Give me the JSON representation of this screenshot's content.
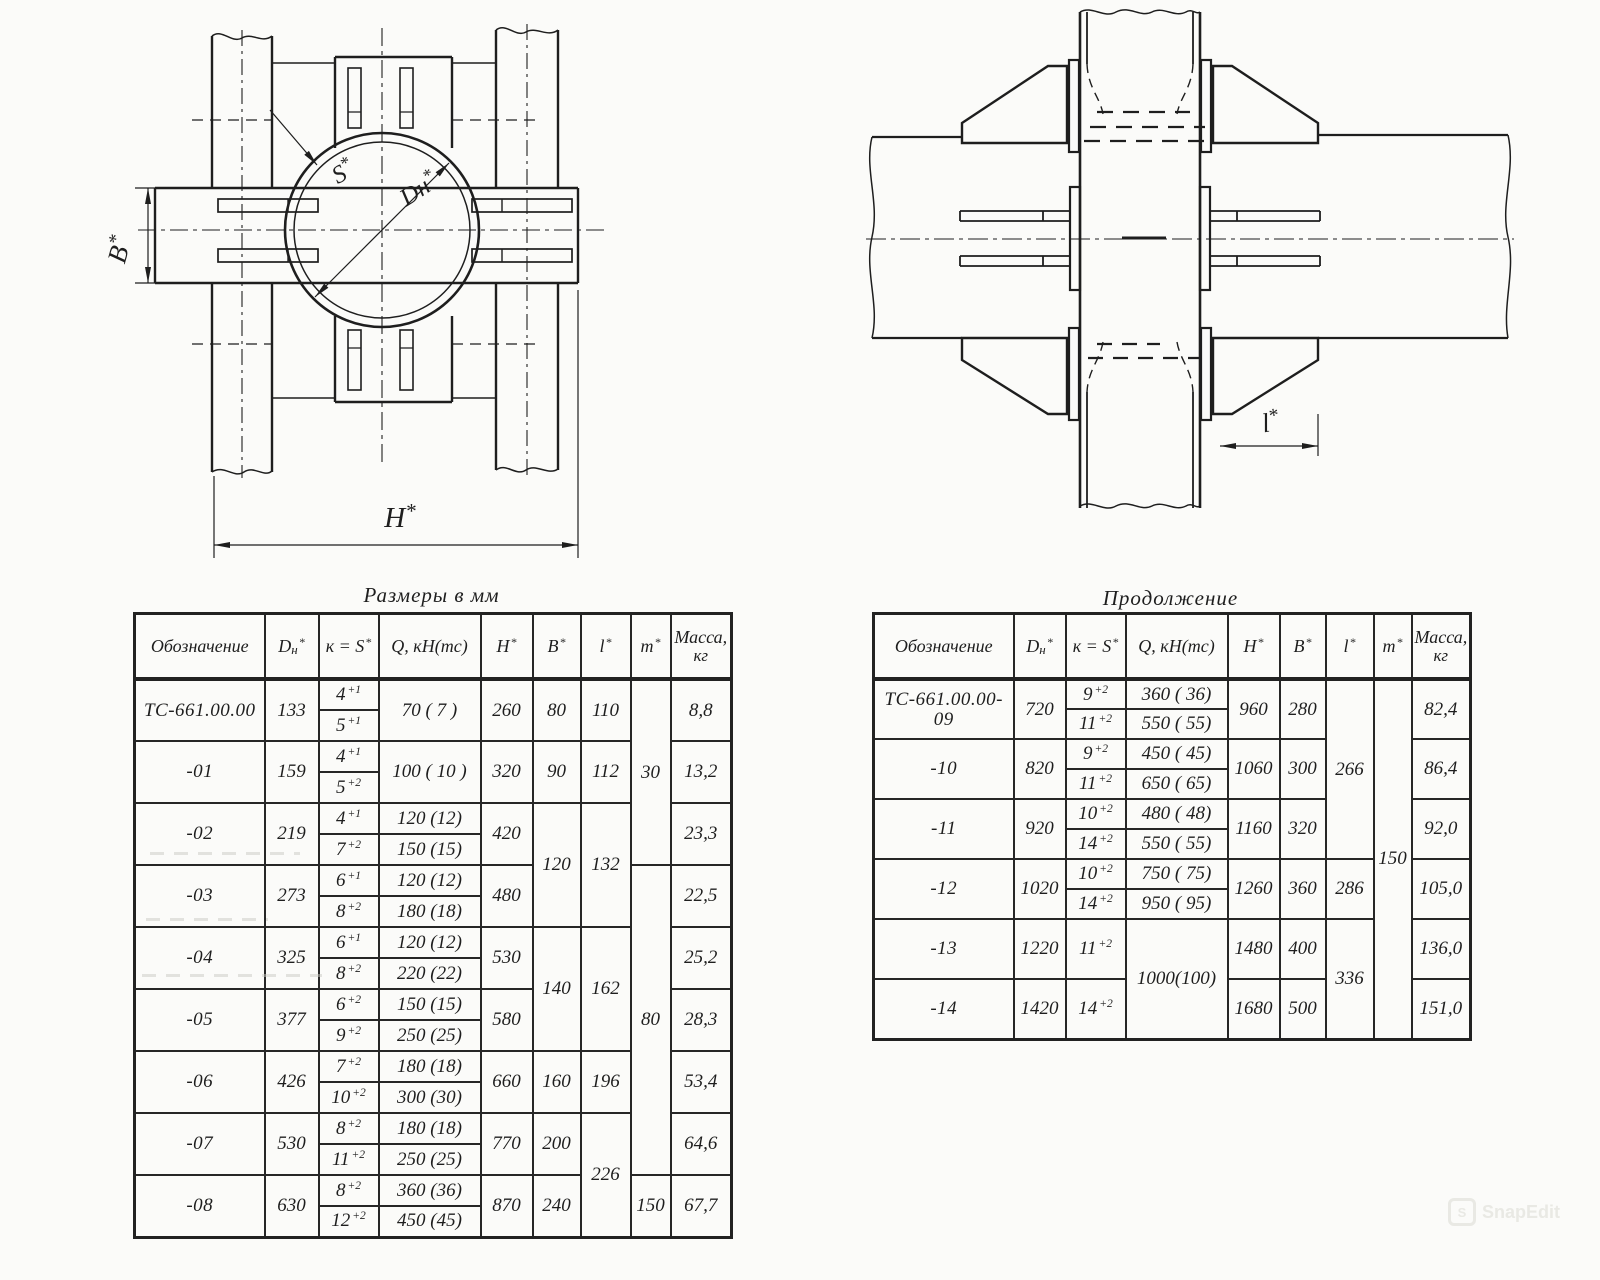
{
  "page": {
    "background": "#fbfbf9",
    "ink": "#1e1e1e"
  },
  "watermark": {
    "text": "SnapEdit",
    "logo": "rounded-square-S"
  },
  "figures": {
    "left_view": {
      "description": "Plan view: pipe cross-section circle with clamp plates, slotted straps and twin vertical beams",
      "labels": {
        "s": "S*",
        "dn": "Dн*",
        "b": "B*",
        "h": "H*"
      }
    },
    "right_view": {
      "description": "Side view: vertical pipe with flange plates, trapezoidal gussets, bolts and horizontal beams",
      "labels": {
        "l": "l*"
      }
    }
  },
  "tables": {
    "left": {
      "title": "Размеры в мм",
      "headers": [
        {
          "text": "Обозначение"
        },
        {
          "text": "D",
          "sub": "н",
          "sup": "*"
        },
        {
          "text": "к = S",
          "sup": "*"
        },
        {
          "text": "Q, кН(тс)"
        },
        {
          "text": "H",
          "sup": "*"
        },
        {
          "text": "B",
          "sup": "*"
        },
        {
          "text": "l",
          "sup": "*"
        },
        {
          "text": "m",
          "sup": "*"
        },
        {
          "text": "Масса,",
          "line2": "кг"
        }
      ],
      "rows": [
        {
          "name": "ТС-661.00.00",
          "dn": "133",
          "k": [
            [
              "4",
              "+1"
            ],
            [
              "5",
              "+1"
            ]
          ],
          "q": [
            "70 ( 7 )"
          ],
          "h": "260",
          "b": {
            "v": "80",
            "rows": 1
          },
          "l": {
            "v": "110",
            "rows": 1
          },
          "m": {
            "v": "30",
            "rows": 3
          },
          "mass": "8,8"
        },
        {
          "name": "-01",
          "dn": "159",
          "k": [
            [
              "4",
              "+1"
            ],
            [
              "5",
              "+2"
            ]
          ],
          "q": [
            "100 ( 10 )"
          ],
          "h": "320",
          "b": {
            "v": "90",
            "rows": 1
          },
          "l": {
            "v": "112",
            "rows": 1
          },
          "m": null,
          "mass": "13,2"
        },
        {
          "name": "-02",
          "dn": "219",
          "k": [
            [
              "4",
              "+1"
            ],
            [
              "7",
              "+2"
            ]
          ],
          "q": [
            "120 (12)",
            "150 (15)"
          ],
          "h": "420",
          "b": {
            "v": "120",
            "rows": 2
          },
          "l": {
            "v": "132",
            "rows": 2
          },
          "m": null,
          "mass": "23,3"
        },
        {
          "name": "-03",
          "dn": "273",
          "k": [
            [
              "6",
              "+1"
            ],
            [
              "8",
              "+2"
            ]
          ],
          "q": [
            "120 (12)",
            "180 (18)"
          ],
          "h": "480",
          "b": null,
          "l": null,
          "m": {
            "v": "80",
            "rows": 5
          },
          "mass": "22,5"
        },
        {
          "name": "-04",
          "dn": "325",
          "k": [
            [
              "6",
              "+1"
            ],
            [
              "8",
              "+2"
            ]
          ],
          "q": [
            "120 (12)",
            "220 (22)"
          ],
          "h": "530",
          "b": {
            "v": "140",
            "rows": 2
          },
          "l": {
            "v": "162",
            "rows": 2
          },
          "m": null,
          "mass": "25,2"
        },
        {
          "name": "-05",
          "dn": "377",
          "k": [
            [
              "6",
              "+2"
            ],
            [
              "9",
              "+2"
            ]
          ],
          "q": [
            "150 (15)",
            "250 (25)"
          ],
          "h": "580",
          "b": null,
          "l": null,
          "m": null,
          "mass": "28,3"
        },
        {
          "name": "-06",
          "dn": "426",
          "k": [
            [
              "7",
              "+2"
            ],
            [
              "10",
              "+2"
            ]
          ],
          "q": [
            "180 (18)",
            "300 (30)"
          ],
          "h": "660",
          "b": {
            "v": "160",
            "rows": 1
          },
          "l": {
            "v": "196",
            "rows": 1
          },
          "m": null,
          "mass": "53,4"
        },
        {
          "name": "-07",
          "dn": "530",
          "k": [
            [
              "8",
              "+2"
            ],
            [
              "11",
              "+2"
            ]
          ],
          "q": [
            "180 (18)",
            "250 (25)"
          ],
          "h": "770",
          "b": {
            "v": "200",
            "rows": 1
          },
          "l": {
            "v": "226",
            "rows": 2
          },
          "m": null,
          "mass": "64,6"
        },
        {
          "name": "-08",
          "dn": "630",
          "k": [
            [
              "8",
              "+2"
            ],
            [
              "12",
              "+2"
            ]
          ],
          "q": [
            "360 (36)",
            "450 (45)"
          ],
          "h": "870",
          "b": {
            "v": "240",
            "rows": 1
          },
          "l": null,
          "m": {
            "v": "150",
            "rows": 1
          },
          "mass": "67,7"
        }
      ]
    },
    "right": {
      "title": "Продолжение",
      "headers": [
        {
          "text": "Обозначение"
        },
        {
          "text": "D",
          "sub": "н",
          "sup": "*"
        },
        {
          "text": "к = S",
          "sup": "*"
        },
        {
          "text": "Q, кН(тс)"
        },
        {
          "text": "H",
          "sup": "*"
        },
        {
          "text": "B",
          "sup": "*"
        },
        {
          "text": "l",
          "sup": "*"
        },
        {
          "text": "m",
          "sup": "*"
        },
        {
          "text": "Масса,",
          "line2": "кг"
        }
      ],
      "rows": [
        {
          "name": "ТС-661.00.00-09",
          "dn": "720",
          "k": [
            [
              "9",
              "+2"
            ],
            [
              "11",
              "+2"
            ]
          ],
          "q": [
            "360 ( 36)",
            "550 ( 55)"
          ],
          "h": "960",
          "b": {
            "v": "280",
            "rows": 1
          },
          "l": {
            "v": "266",
            "rows": 3
          },
          "m": {
            "v": "150",
            "rows": 6
          },
          "mass": "82,4"
        },
        {
          "name": "-10",
          "dn": "820",
          "k": [
            [
              "9",
              "+2"
            ],
            [
              "11",
              "+2"
            ]
          ],
          "q": [
            "450 ( 45)",
            "650 ( 65)"
          ],
          "h": "1060",
          "b": {
            "v": "300",
            "rows": 1
          },
          "l": null,
          "m": null,
          "mass": "86,4"
        },
        {
          "name": "-11",
          "dn": "920",
          "k": [
            [
              "10",
              "+2"
            ],
            [
              "14",
              "+2"
            ]
          ],
          "q": [
            "480 ( 48)",
            "550 ( 55)"
          ],
          "h": "1160",
          "b": {
            "v": "320",
            "rows": 1
          },
          "l": null,
          "m": null,
          "mass": "92,0"
        },
        {
          "name": "-12",
          "dn": "1020",
          "k": [
            [
              "10",
              "+2"
            ],
            [
              "14",
              "+2"
            ]
          ],
          "q": [
            "750 ( 75)",
            "950 ( 95)"
          ],
          "h": "1260",
          "b": {
            "v": "360",
            "rows": 1
          },
          "l": {
            "v": "286",
            "rows": 1
          },
          "m": null,
          "mass": "105,0"
        },
        {
          "name": "-13",
          "dn": "1220",
          "k": [
            [
              "11",
              "+2"
            ]
          ],
          "q": [
            "1000(100)"
          ],
          "qspan": 2,
          "h": "1480",
          "b": {
            "v": "400",
            "rows": 1
          },
          "l": {
            "v": "336",
            "rows": 2
          },
          "m": null,
          "mass": "136,0"
        },
        {
          "name": "-14",
          "dn": "1420",
          "k": [
            [
              "14",
              "+2"
            ]
          ],
          "q": null,
          "h": "1680",
          "b": {
            "v": "500",
            "rows": 1
          },
          "l": null,
          "m": null,
          "mass": "151,0"
        }
      ]
    }
  }
}
